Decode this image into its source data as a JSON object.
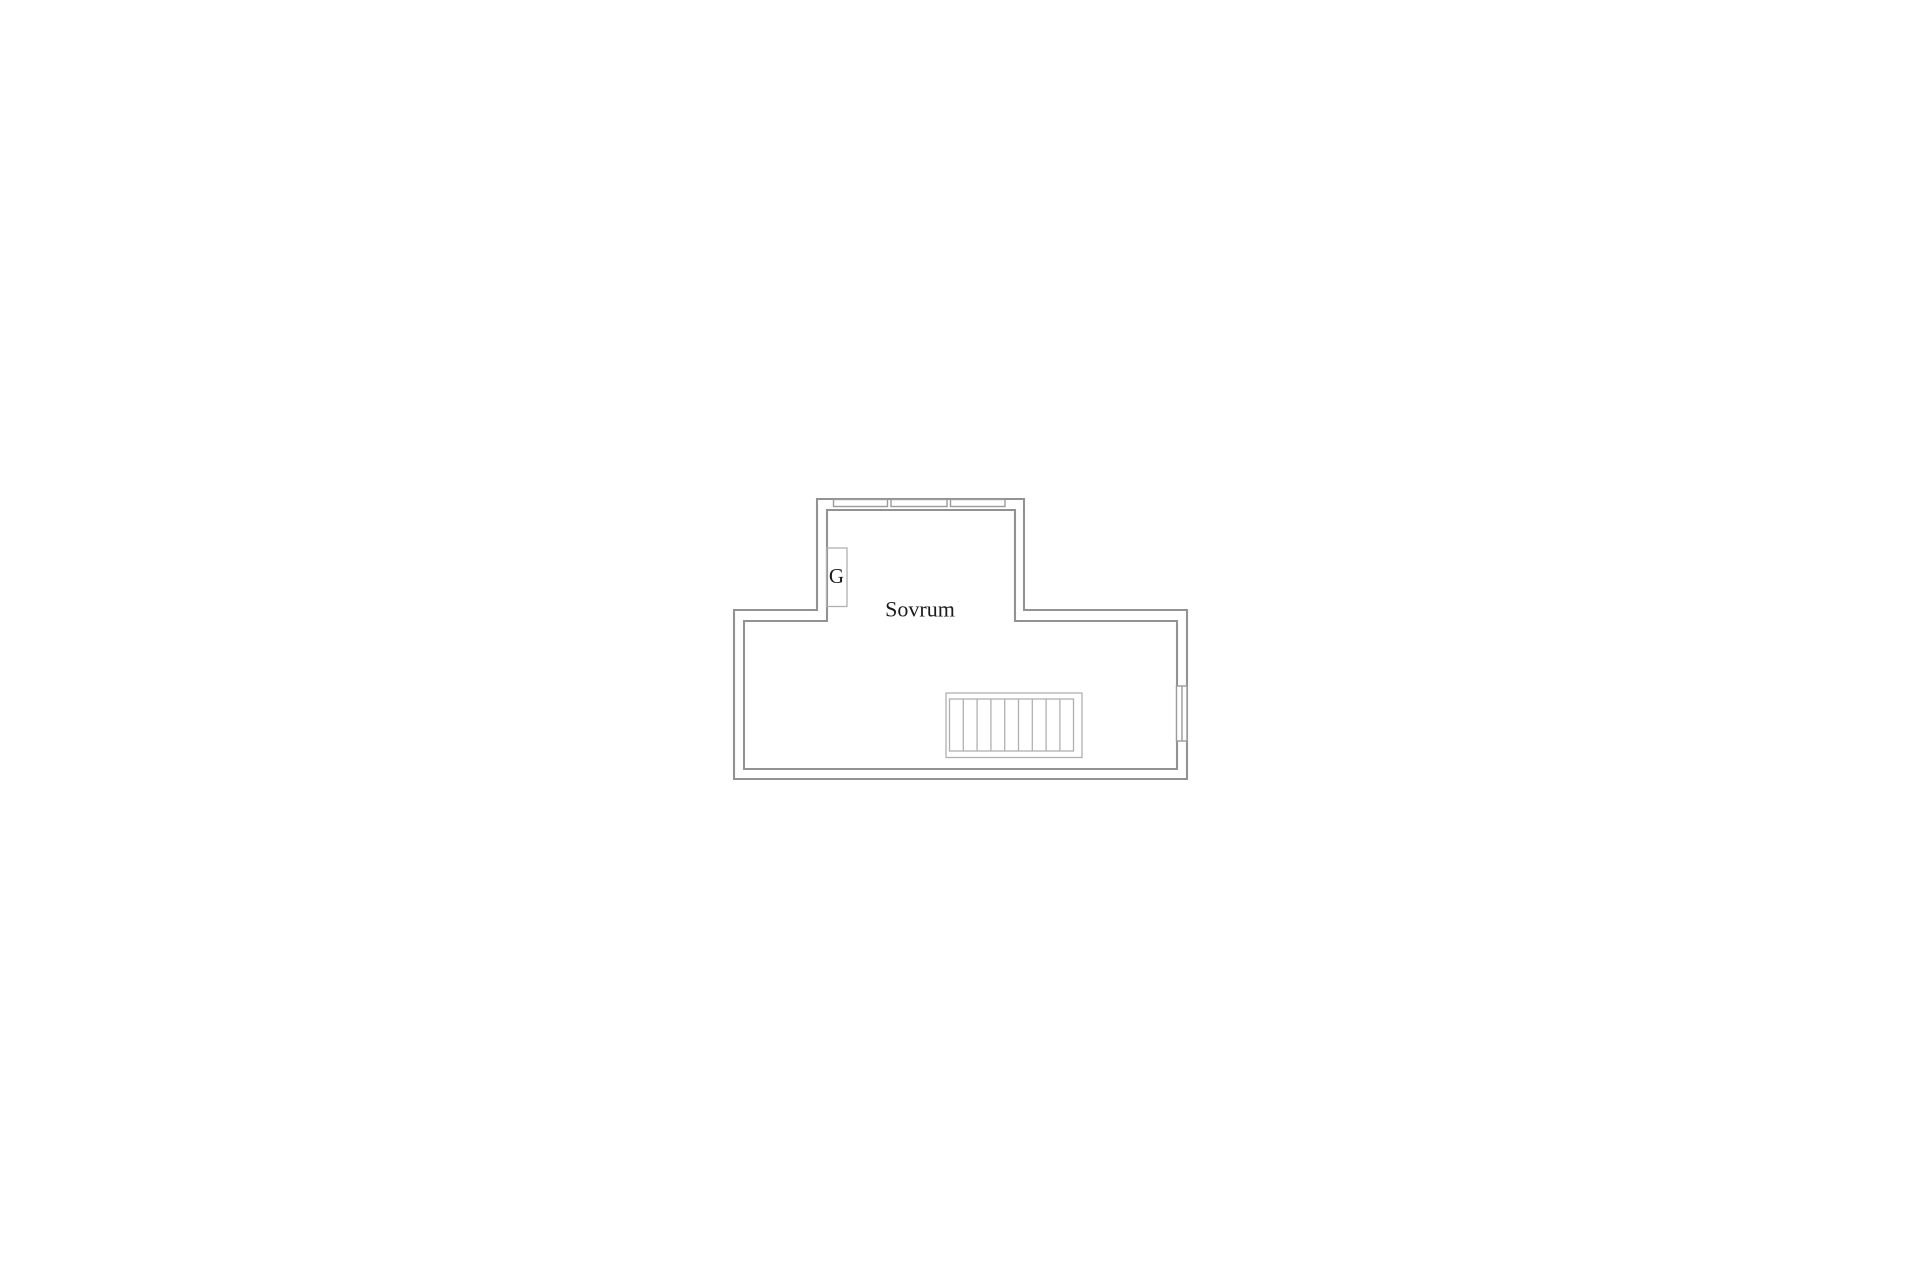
{
  "plan": {
    "room_label": "Sovrum",
    "closet_label": "G",
    "colors": {
      "background": "#ffffff",
      "wall": "#929292",
      "window": "#9b9b9b",
      "fixture": "#b0b0b0",
      "text": "#1b1b1b"
    }
  }
}
